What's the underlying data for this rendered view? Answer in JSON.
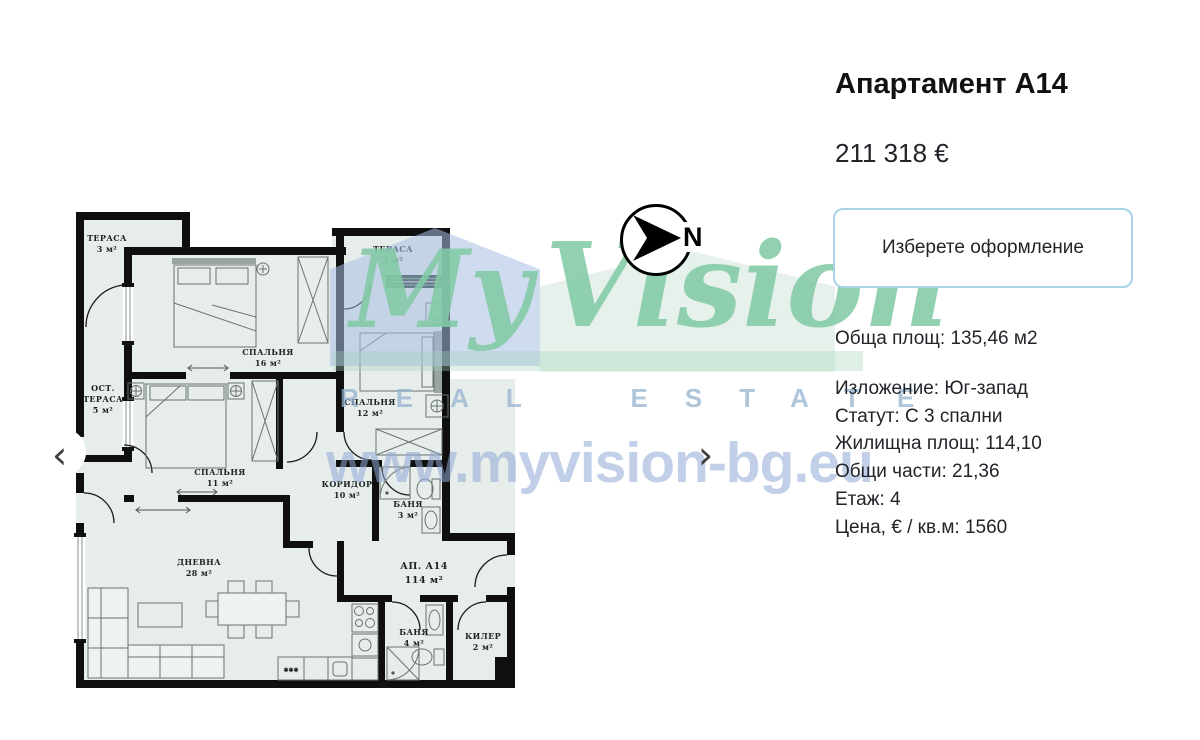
{
  "panel": {
    "title": "Апартамент А14",
    "price": "211 318 €",
    "button_label": "Изберете оформление",
    "total_area": "Обща площ: 135,46 м2",
    "details": [
      "Изложение: Юг-запад",
      "Статут: С 3 спални",
      "Жилищна площ: 114,10",
      "Общи части: 21,36",
      "Етаж: 4",
      "Цена, € / кв.м: 1560"
    ]
  },
  "compass": {
    "label": "N"
  },
  "carousel": {
    "prev_label": "‹",
    "next_label": "›"
  },
  "watermark": {
    "brand_first": "My",
    "brand_second": "Vision",
    "tagline": "REAL ESTATE",
    "url": "www.myvision-bg.eu"
  },
  "floorplan": {
    "rooms": {
      "terrace_tl": {
        "name": "ТЕРАСА",
        "area": "3 м²"
      },
      "bedroom16": {
        "name": "СПАЛЬНЯ",
        "area": "16 м²"
      },
      "ost_terrace": {
        "name": "ОСТ.",
        "name2": "ТЕРАСА",
        "area": "5 м²"
      },
      "bedroom11": {
        "name": "СПАЛЬНЯ",
        "area": "11 м²"
      },
      "terrace_tr": {
        "name": "ТЕРАСА",
        "area": "3 м²"
      },
      "bedroom12": {
        "name": "СПАЛЬНЯ",
        "area": "12 м²"
      },
      "corridor": {
        "name": "КОРИДОР",
        "area": "10 м²"
      },
      "bath3": {
        "name": "БАНЯ",
        "area": "3 м²"
      },
      "apartment": {
        "name": "АП. А14",
        "area": "114 м²"
      },
      "living": {
        "name": "ДНЕВНА",
        "area": "28 м²"
      },
      "bath4": {
        "name": "БАНЯ",
        "area": "4 м²"
      },
      "closet": {
        "name": "КИЛЕР",
        "area": "2 м²"
      }
    },
    "kitchen_marks": "✱✱✱"
  },
  "colors": {
    "button_border": "#a9d3e8",
    "watermark_green": "#82caa6",
    "watermark_blue": "#90a8d6",
    "plan_room_fill": "#e7edea",
    "plan_wall": "#0f0f0f"
  }
}
